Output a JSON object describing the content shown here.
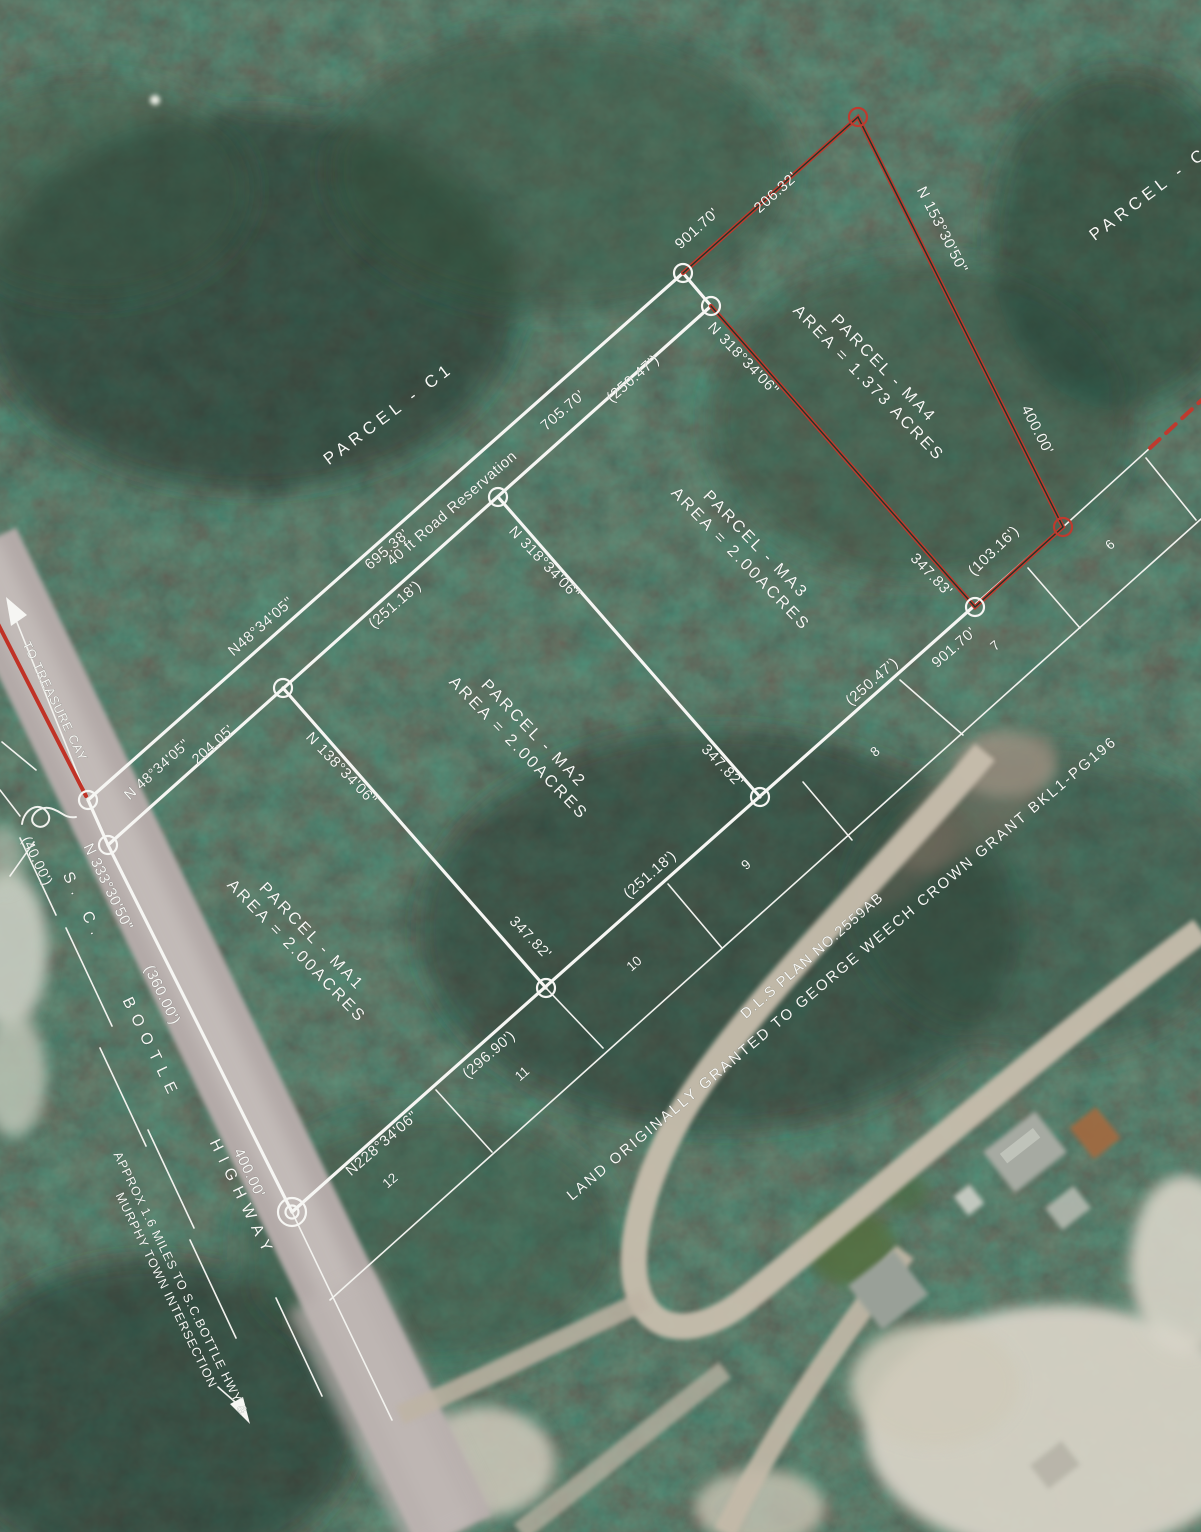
{
  "colors": {
    "line_white": "#f6f6f3",
    "line_red": "#bf3a2e",
    "forest": "#263d33",
    "road": "#b3aaa8",
    "sand": "#c8bead"
  },
  "parcels": {
    "c1": "PARCEL - C1",
    "c_right": "PARCEL - C",
    "ma1": {
      "name": "PARCEL - MA1",
      "area": "AREA = 2.00ACRES"
    },
    "ma2": {
      "name": "PARCEL - MA2",
      "area": "AREA = 2.00ACRES"
    },
    "ma3": {
      "name": "PARCEL - MA3",
      "area": "AREA = 2.00ACRES"
    },
    "ma4": {
      "name": "PARCEL - MA4",
      "area": "AREA = 1.373 ACRES"
    }
  },
  "bearings": {
    "n153": "N 153°30'50\"",
    "n318_ma4": "N 318°34'06\"",
    "n318_ma3": "N 318°34'06\"",
    "n138": "N 138°34'06\"",
    "n48_long": "N48°34'05\"",
    "n48_short": "N 48°34'05\"",
    "n228": "N228°34'06\"",
    "n333": "N 333°30'50\""
  },
  "distances": {
    "d901_top": "901.70'",
    "d206": "206.32'",
    "d400_ne": "400.00'",
    "d705": "705.70'",
    "d250_road": "(250.47')",
    "d695": "695.38'",
    "d251_road": "(251.18')",
    "d204": "204.05'",
    "d347_34": "347.83'",
    "d103": "(103.16')",
    "d901_se": "901.70'",
    "d250_se": "(250.47')",
    "d347_23": "347.82'",
    "d251_se": "(251.18')",
    "d347_12": "347.82'",
    "d296": "(296.90')",
    "d360": "(360.00')",
    "d400_hwy": "400.00'",
    "d40": "(40.00')"
  },
  "roads": {
    "reservation": "40 ft Road Reservation",
    "hwy_sc": "S. C.",
    "hwy_bootle": "BOOTLE",
    "hwy_highway": "HIGHWAY",
    "to_treasure": "TO TREASURE CAY",
    "approx_line1": "APPROX 1.6 MILES TO S.C.BOTTLE HWY &",
    "approx_line2": "MURPHY TOWN INTERSECTION"
  },
  "lots": {
    "l6": "6",
    "l7": "7",
    "l8": "8",
    "l9": "9",
    "l10": "10",
    "l11": "11",
    "l12": "12"
  },
  "notes": {
    "dls": "D.L.S PLAN NO.2559AB",
    "grant": "LAND ORIGINALLY GRANTED TO GEORGE WEECH CROWN GRANT BKL1-PG196"
  }
}
